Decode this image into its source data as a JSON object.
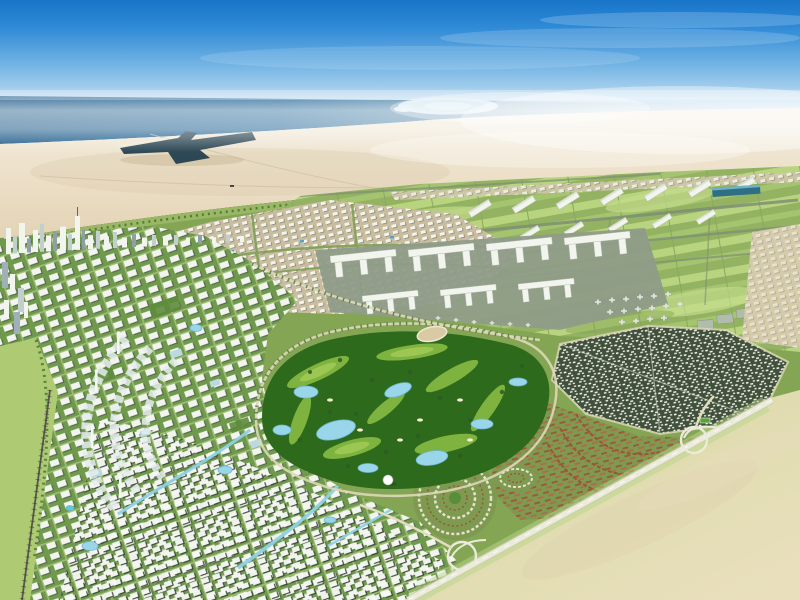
{
  "image": {
    "kind": "aerial-masterplan-rendering",
    "description": "Bird's-eye 3D rendering of a coastal desert master-planned city: sea and palm island on the horizon, sand belt with a port inlet, white high-rise city on the left, logistics grid, airport with hangars, terminals and parked aircraft, dark diamond district, red-brown villa communities, central golf course with lakes, and an empty field beyond a diagonal highway at bottom right",
    "visible_text": []
  },
  "colors": {
    "sky_top": "#1875c8",
    "sky_mid": "#6fb2e4",
    "sky_haze": "#f0f3f2",
    "sea_dark": "#1d5a88",
    "sea_mid": "#2e6f9e",
    "palm_island": "#d8ecf4",
    "desert_light": "#f3edde",
    "desert_mid": "#e6d8bd",
    "desert_shadow": "#d8c8a9",
    "port_water": "#24404f",
    "green_base": "#84a654",
    "green_fringe": "#9dba6a",
    "airfield_light": "#b8d47e",
    "airfield_mid": "#93b362",
    "taxiway_gray": "#7e8e74",
    "apron_gray": "#8f9c88",
    "building_white": "#f2f4ee",
    "building_shadow": "#57684e",
    "glass_blue": "#bcd9e0",
    "hangar_blue": "#2e6f85",
    "dark_district": "#41503b",
    "villa_brown": "#9a5638",
    "villa_light": "#b06a44",
    "golf_dark": "#2e6a1c",
    "golf_fairway": "#7db33e",
    "golf_highlight": "#a3cc57",
    "lake_blue": "#9ad6ea",
    "canal_blue": "#8ed2e6",
    "road_pale": "#ddd8b8",
    "tree_dark": "#2f5a22",
    "field_green": "#cfe39b",
    "field_tan": "#e9dfbd",
    "city_ground": "#6f9a4c",
    "west_strip": "#aecb74"
  }
}
